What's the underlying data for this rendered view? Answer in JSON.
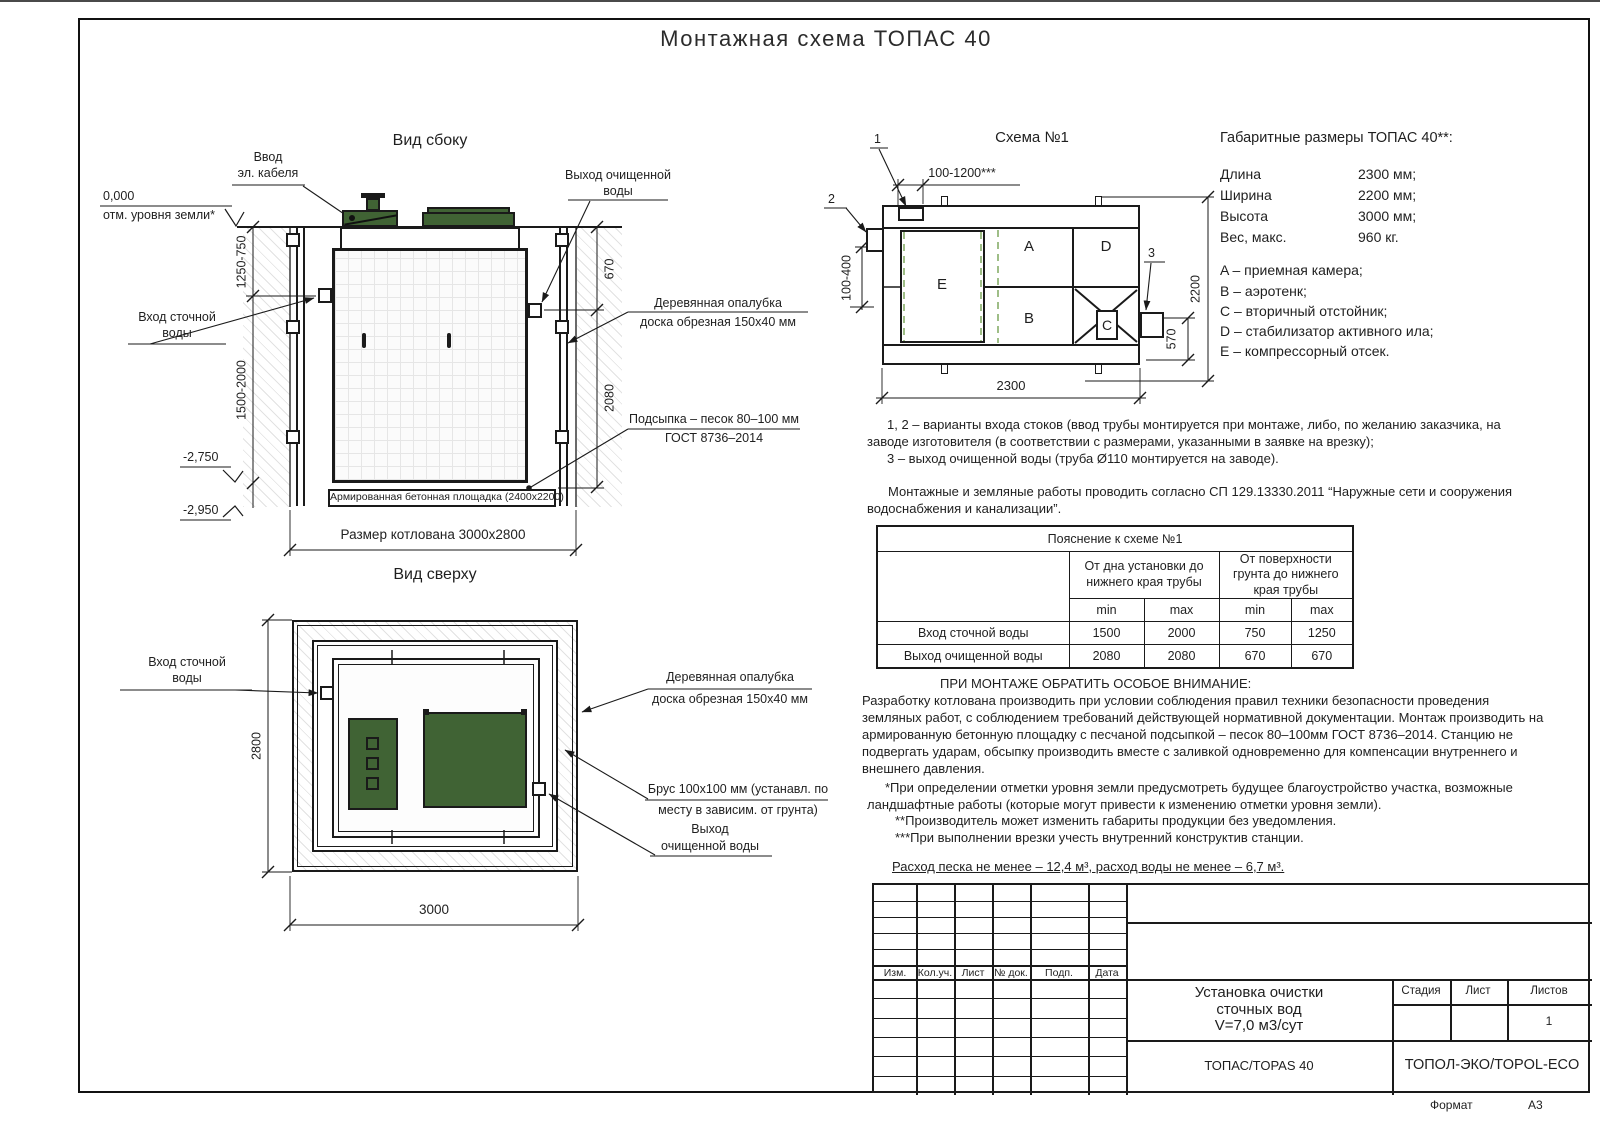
{
  "page": {
    "title": "Монтажная схема ТОПАС 40",
    "format_label": "Формат",
    "format_value": "А3"
  },
  "side_view": {
    "title": "Вид сбоку",
    "cable_label_1": "Ввод",
    "cable_label_2": "эл. кабеля",
    "outlet_label_1": "Выход очищенной",
    "outlet_label_2": "воды",
    "zero_mark": "0,000",
    "ground_mark": "отм. уровня земли*",
    "inlet_label_1": "Вход сточной",
    "inlet_label_2": "воды",
    "level_1": "-2,750",
    "level_2": "-2,950",
    "dim_upper": "1250-750",
    "dim_lower": "1500-2000",
    "dim_out_top": "670",
    "dim_out_bottom": "2080",
    "formwork_label_1": "Деревянная опалубка",
    "formwork_label_2": "доска обрезная 150х40 мм",
    "bedding_label_1": "Подсыпка – песок 80–100 мм",
    "bedding_label_2": "ГОСТ 8736–2014",
    "slab_label": "Армированная бетонная площадка (2400х2200)",
    "pit_dim": "Размер котлована 3000х2800"
  },
  "top_view": {
    "title": "Вид сверху",
    "inlet_label_1": "Вход сточной",
    "inlet_label_2": "воды",
    "formwork_label_1": "Деревянная опалубка",
    "formwork_label_2": "доска обрезная 150х40 мм",
    "beam_label_1": "Брус 100х100 мм (устанавл. по",
    "beam_label_2": "месту в зависим. от грунта)",
    "outlet_label_1": "Выход",
    "outlet_label_2": "очищенной воды",
    "dim_width": "2800",
    "dim_length": "3000"
  },
  "scheme": {
    "title": "Схема №1",
    "marker_1": "1",
    "marker_2": "2",
    "marker_3": "3",
    "dim_top": "100-1200***",
    "dim_left": "100-400",
    "dim_bottom": "2300",
    "dim_right": "2200",
    "dim_outlet": "570",
    "chamber_a": "A",
    "chamber_b": "B",
    "chamber_c": "C",
    "chamber_d": "D",
    "chamber_e": "E"
  },
  "overall": {
    "header": "Габаритные размеры ТОПАС 40**:",
    "rows": [
      {
        "label": "Длина",
        "value": "2300 мм;"
      },
      {
        "label": "Ширина",
        "value": "2200 мм;"
      },
      {
        "label": "Высота",
        "value": "3000 мм;"
      },
      {
        "label": "Вес, макс.",
        "value": "960 кг."
      }
    ],
    "legend": [
      "A – приемная камера;",
      "B – аэротенк;",
      "C – вторичный отстойник;",
      "D – стабилизатор активного ила;",
      "E – компрессорный отсек."
    ]
  },
  "notes": {
    "variants": [
      "1, 2 – варианты входа  стоков (ввод трубы монтируется при монтаже, либо, по желанию заказчика, на",
      "заводе изготовителя (в соответствии с размерами, указанными в заявке на врезку);",
      "3 – выход очищенной воды (труба Ø110 монтируется на заводе)."
    ],
    "sp": [
      "Монтажные и земляные работы проводить согласно СП 129.13330.2011 “Наружные сети и сооружения",
      "водоснабжения и канализации”."
    ],
    "attention_title": "ПРИ МОНТАЖЕ ОБРАТИТЬ ОСОБОЕ ВНИМАНИЕ:",
    "attention": [
      "Разработку котлована производить при условии соблюдения правил техники безопасности проведения",
      "земляных работ, с соблюдением требований действующей нормативной документации.  Монтаж производить на",
      "армированную бетонную площадку с песчаной подсыпкой – песок 80–100мм ГОСТ 8736–2014. Станцию не",
      "подвергать ударам, обсыпку производить вместе с заливкой одновременно для компенсации внутреннего и",
      "внешнего давления."
    ],
    "footnotes": [
      "*При определении отметки уровня земли предусмотреть будущее благоустройство участка, возможные",
      "ландшафтные работы (которые могут привести к изменению отметки уровня земли).",
      "**Производитель может изменить габариты продукции без уведомления.",
      "***При выполнении врезки учесть внутренний конструктив станции."
    ],
    "consumption": "Расход песка не менее – 12,4 м³, расход воды не менее – 6,7 м³."
  },
  "table": {
    "title": "Пояснение к схеме №1",
    "col_group_1": "От дна установки до нижнего края трубы",
    "col_group_2": "От поверхности грунта до нижнего края трубы",
    "min_label": "min",
    "max_label": "max",
    "rows": [
      {
        "label": "Вход сточной воды",
        "values": [
          "1500",
          "2000",
          "750",
          "1250"
        ]
      },
      {
        "label": "Выход очищенной воды",
        "values": [
          "2080",
          "2080",
          "670",
          "670"
        ]
      }
    ]
  },
  "stamp": {
    "cols": [
      "Изм.",
      "Кол.уч.",
      "Лист",
      "№ док.",
      "Подп.",
      "Дата"
    ],
    "title_lines": [
      "Установка очистки",
      "сточных вод",
      "V=7,0 м3/сут"
    ],
    "stage_label": "Стадия",
    "sheet_label": "Лист",
    "sheets_label": "Листов",
    "sheets_value": "1",
    "model": "ТОПАС/TOPAS 40",
    "company": "ТОПОЛ-ЭКО/TOPOL-ECO"
  }
}
